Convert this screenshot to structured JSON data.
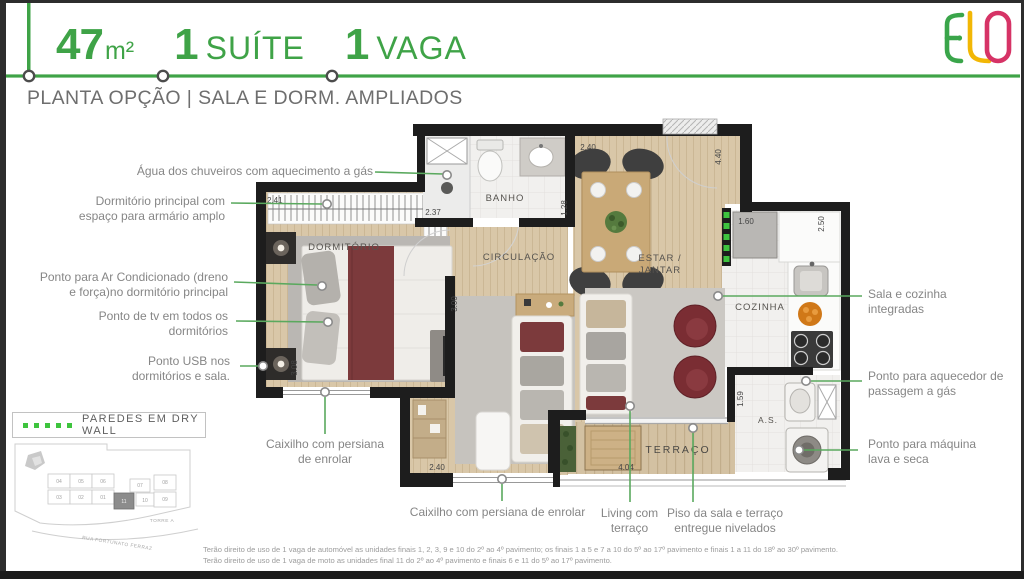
{
  "header": {
    "area_number": "47",
    "area_unit": "m²",
    "stat1_number": "1",
    "stat1_label": "SUÍTE",
    "stat2_number": "1",
    "stat2_label": "VAGA",
    "subtitle": "PLANTA OPÇÃO | SALA E DORM. AMPLIADOS",
    "logo_text": "ELO"
  },
  "colors": {
    "accent_green": "#3FA347",
    "drywall_green": "#3EC43E",
    "logo_green": "#3AA54A",
    "logo_yellow": "#F2B705",
    "logo_pink": "#D63366"
  },
  "plan": {
    "rooms": {
      "banho": "BANHO",
      "dormitorio": "DORMITÓRIO",
      "circulacao": "CIRCULAÇÃO",
      "estar_line1": "ESTAR /",
      "estar_line2": "JANTAR",
      "cozinha": "COZINHA",
      "area_servico": "A.S.",
      "terraco": "TERRAÇO"
    },
    "dimensions": {
      "closet_width": "2.41",
      "banho_width": "2.37",
      "banho_depth": "1.28",
      "estar_width": "2.40",
      "estar_depth": "4.40",
      "cozinha_width": "1.60",
      "cozinha_depth": "2.50",
      "dorm_depth": "3.08",
      "sala_depth": "3.00",
      "sala_width": "2.40",
      "terraco_width": "4.04",
      "as_depth": "1.59"
    }
  },
  "callouts": {
    "left": [
      {
        "text": "Água dos chuveiros com aquecimento a gás"
      },
      {
        "text": "Dormitório principal com\nespaço para armário amplo"
      },
      {
        "text": "Ponto para Ar Condicionado (dreno\ne força)no dormitório principal"
      },
      {
        "text": "Ponto de tv em todos os\ndormitórios"
      },
      {
        "text": "Ponto USB nos\ndormitórios e sala."
      },
      {
        "text": "Caixilho com persiana\nde enrolar"
      }
    ],
    "right": [
      {
        "text": "Sala e cozinha\nintegradas"
      },
      {
        "text": "Ponto para aquecedor de\npassagem a gás"
      },
      {
        "text": "Ponto para máquina\nlava e seca"
      }
    ],
    "bottom": [
      {
        "text": "Caixilho com persiana de enrolar"
      },
      {
        "text": "Living com\nterraço"
      },
      {
        "text": "Piso da sala e terraço\nentregue nivelados"
      }
    ]
  },
  "legend": {
    "drywall": "PAREDES EM DRY WALL"
  },
  "keyplan": {
    "tower_label": "TORRE A",
    "street_label": "RUA FORTUNATO FERRAZ",
    "units_top": [
      "04",
      "05",
      "06",
      "07",
      "08"
    ],
    "units_bottom": [
      "03",
      "02",
      "01",
      "11",
      "10",
      "09"
    ],
    "highlighted_unit": "11"
  },
  "disclaimer": {
    "line1": "Terão direito de uso de 1 vaga de automóvel as unidades finais 1, 2, 3, 9 e 10 do 2º ao 4º pavimento; os finais 1 a 5 e 7 a 10 do 5º ao 17º pavimento e finais 1 a 11 do 18º ao 30º pavimento.",
    "line2": "Terão direito de uso de 1 vaga de moto as unidades final 11 do 2º ao 4º pavimento e finais 6 e 11 do 5º ao 17º pavimento."
  }
}
